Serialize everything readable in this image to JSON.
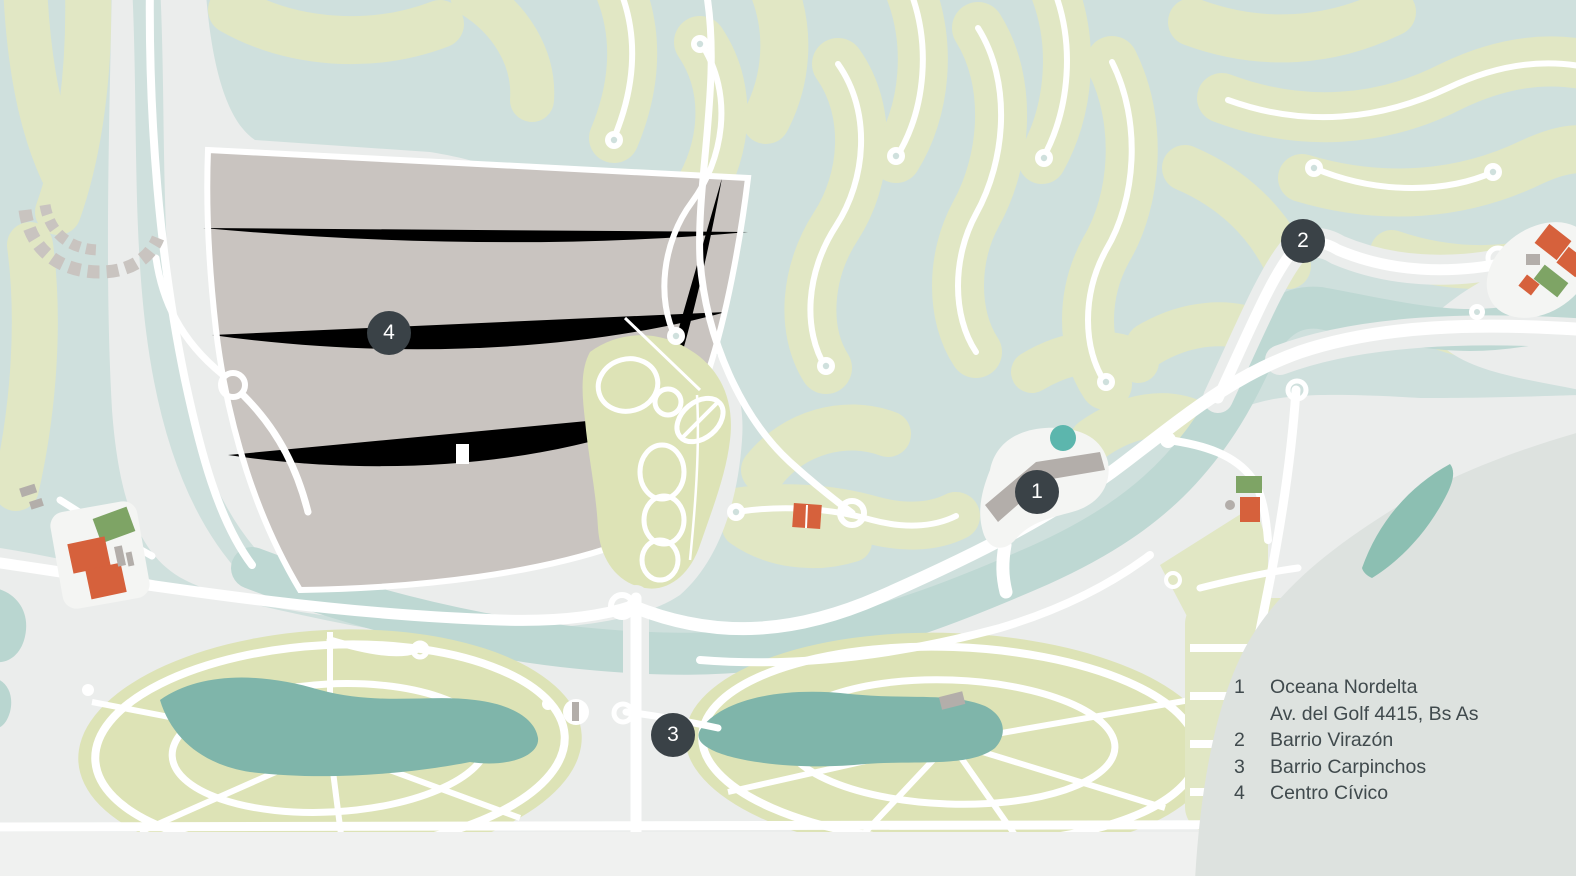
{
  "legend": {
    "items": [
      {
        "number": "1",
        "lines": [
          "Oceana Nordelta",
          "Av. del Golf 4415, Bs As"
        ]
      },
      {
        "number": "2",
        "lines": [
          "Barrio Virazón"
        ]
      },
      {
        "number": "3",
        "lines": [
          "Barrio Carpinchos"
        ]
      },
      {
        "number": "4",
        "lines": [
          "Centro Cívico"
        ]
      }
    ]
  },
  "markers": [
    {
      "number": "1",
      "label": "Oceana Nordelta"
    },
    {
      "number": "2",
      "label": "Barrio Virazón"
    },
    {
      "number": "3",
      "label": "Barrio Carpinchos"
    },
    {
      "number": "4",
      "label": "Centro Cívico"
    }
  ],
  "colors": {
    "water": "#cfe0dd",
    "channel": "#bed8d3",
    "land_gray": "#ebedec",
    "ground_white": "#f4f5f3",
    "strip_green": "#e1e7c4",
    "barrio_green": "#dde3b6",
    "block_gray": "#c9c4c0",
    "building_gray": "#b3aeaa",
    "lake_teal": "#7fb5aa",
    "pool_teal": "#5cb6ad",
    "pond_teal": "#b9d6d0",
    "building_orange": "#d6613c",
    "building_green": "#7ea465",
    "road_white": "#ffffff",
    "marker_dark": "#3a4247",
    "panel_gray": "#dde2df",
    "crescent_teal": "#8cbfb2",
    "bottom_band": "#f0f1f0",
    "pale_wedge": "#eef0d8",
    "legend_text": "#404a4d"
  }
}
